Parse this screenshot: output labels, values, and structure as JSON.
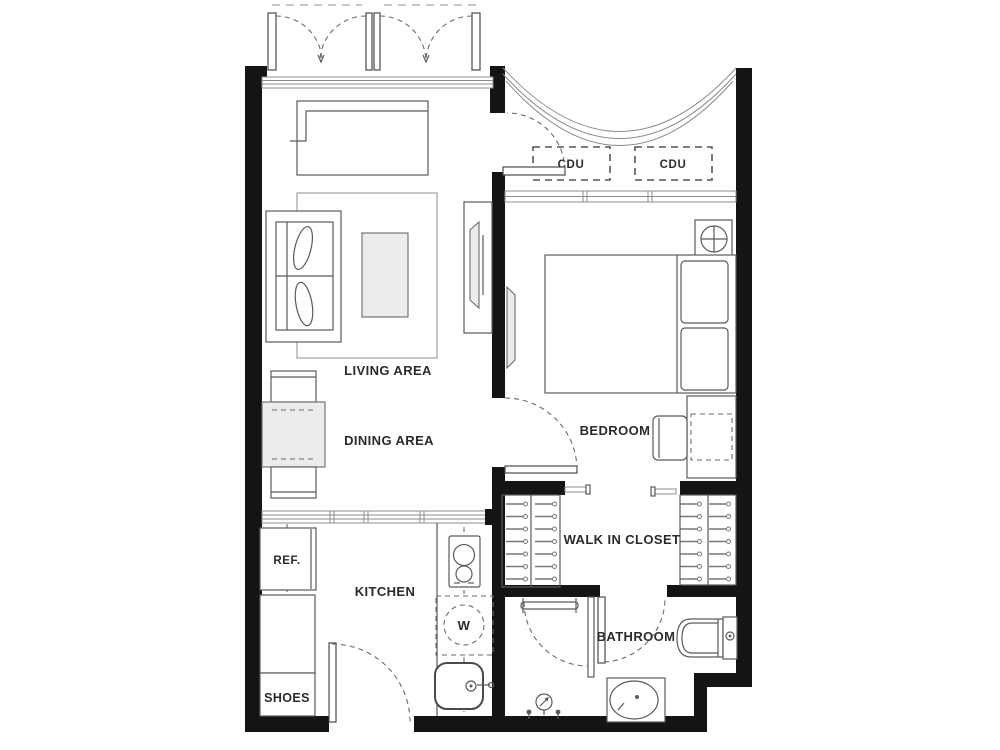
{
  "floor_plan": {
    "rooms": {
      "living": {
        "label": "LIVING AREA"
      },
      "dining": {
        "label": "DINING AREA"
      },
      "bedroom": {
        "label": "BEDROOM"
      },
      "closet": {
        "label": "WALK IN CLOSET"
      },
      "bathroom": {
        "label": "BATHROOM"
      },
      "kitchen": {
        "label": "KITCHEN"
      }
    },
    "fixtures": {
      "refrigerator": {
        "label": "REF."
      },
      "shoes_cabinet": {
        "label": "SHOES"
      },
      "washer": {
        "label": "W"
      },
      "cdu_left": {
        "label": "CDU"
      },
      "cdu_right": {
        "label": "CDU"
      }
    },
    "colors": {
      "background": "#ffffff",
      "wall": "#141414",
      "furniture_line": "#5a5a5a",
      "light_line": "#8c8c8c",
      "light_fill": "#ececec",
      "text": "#2b2b2b"
    }
  }
}
